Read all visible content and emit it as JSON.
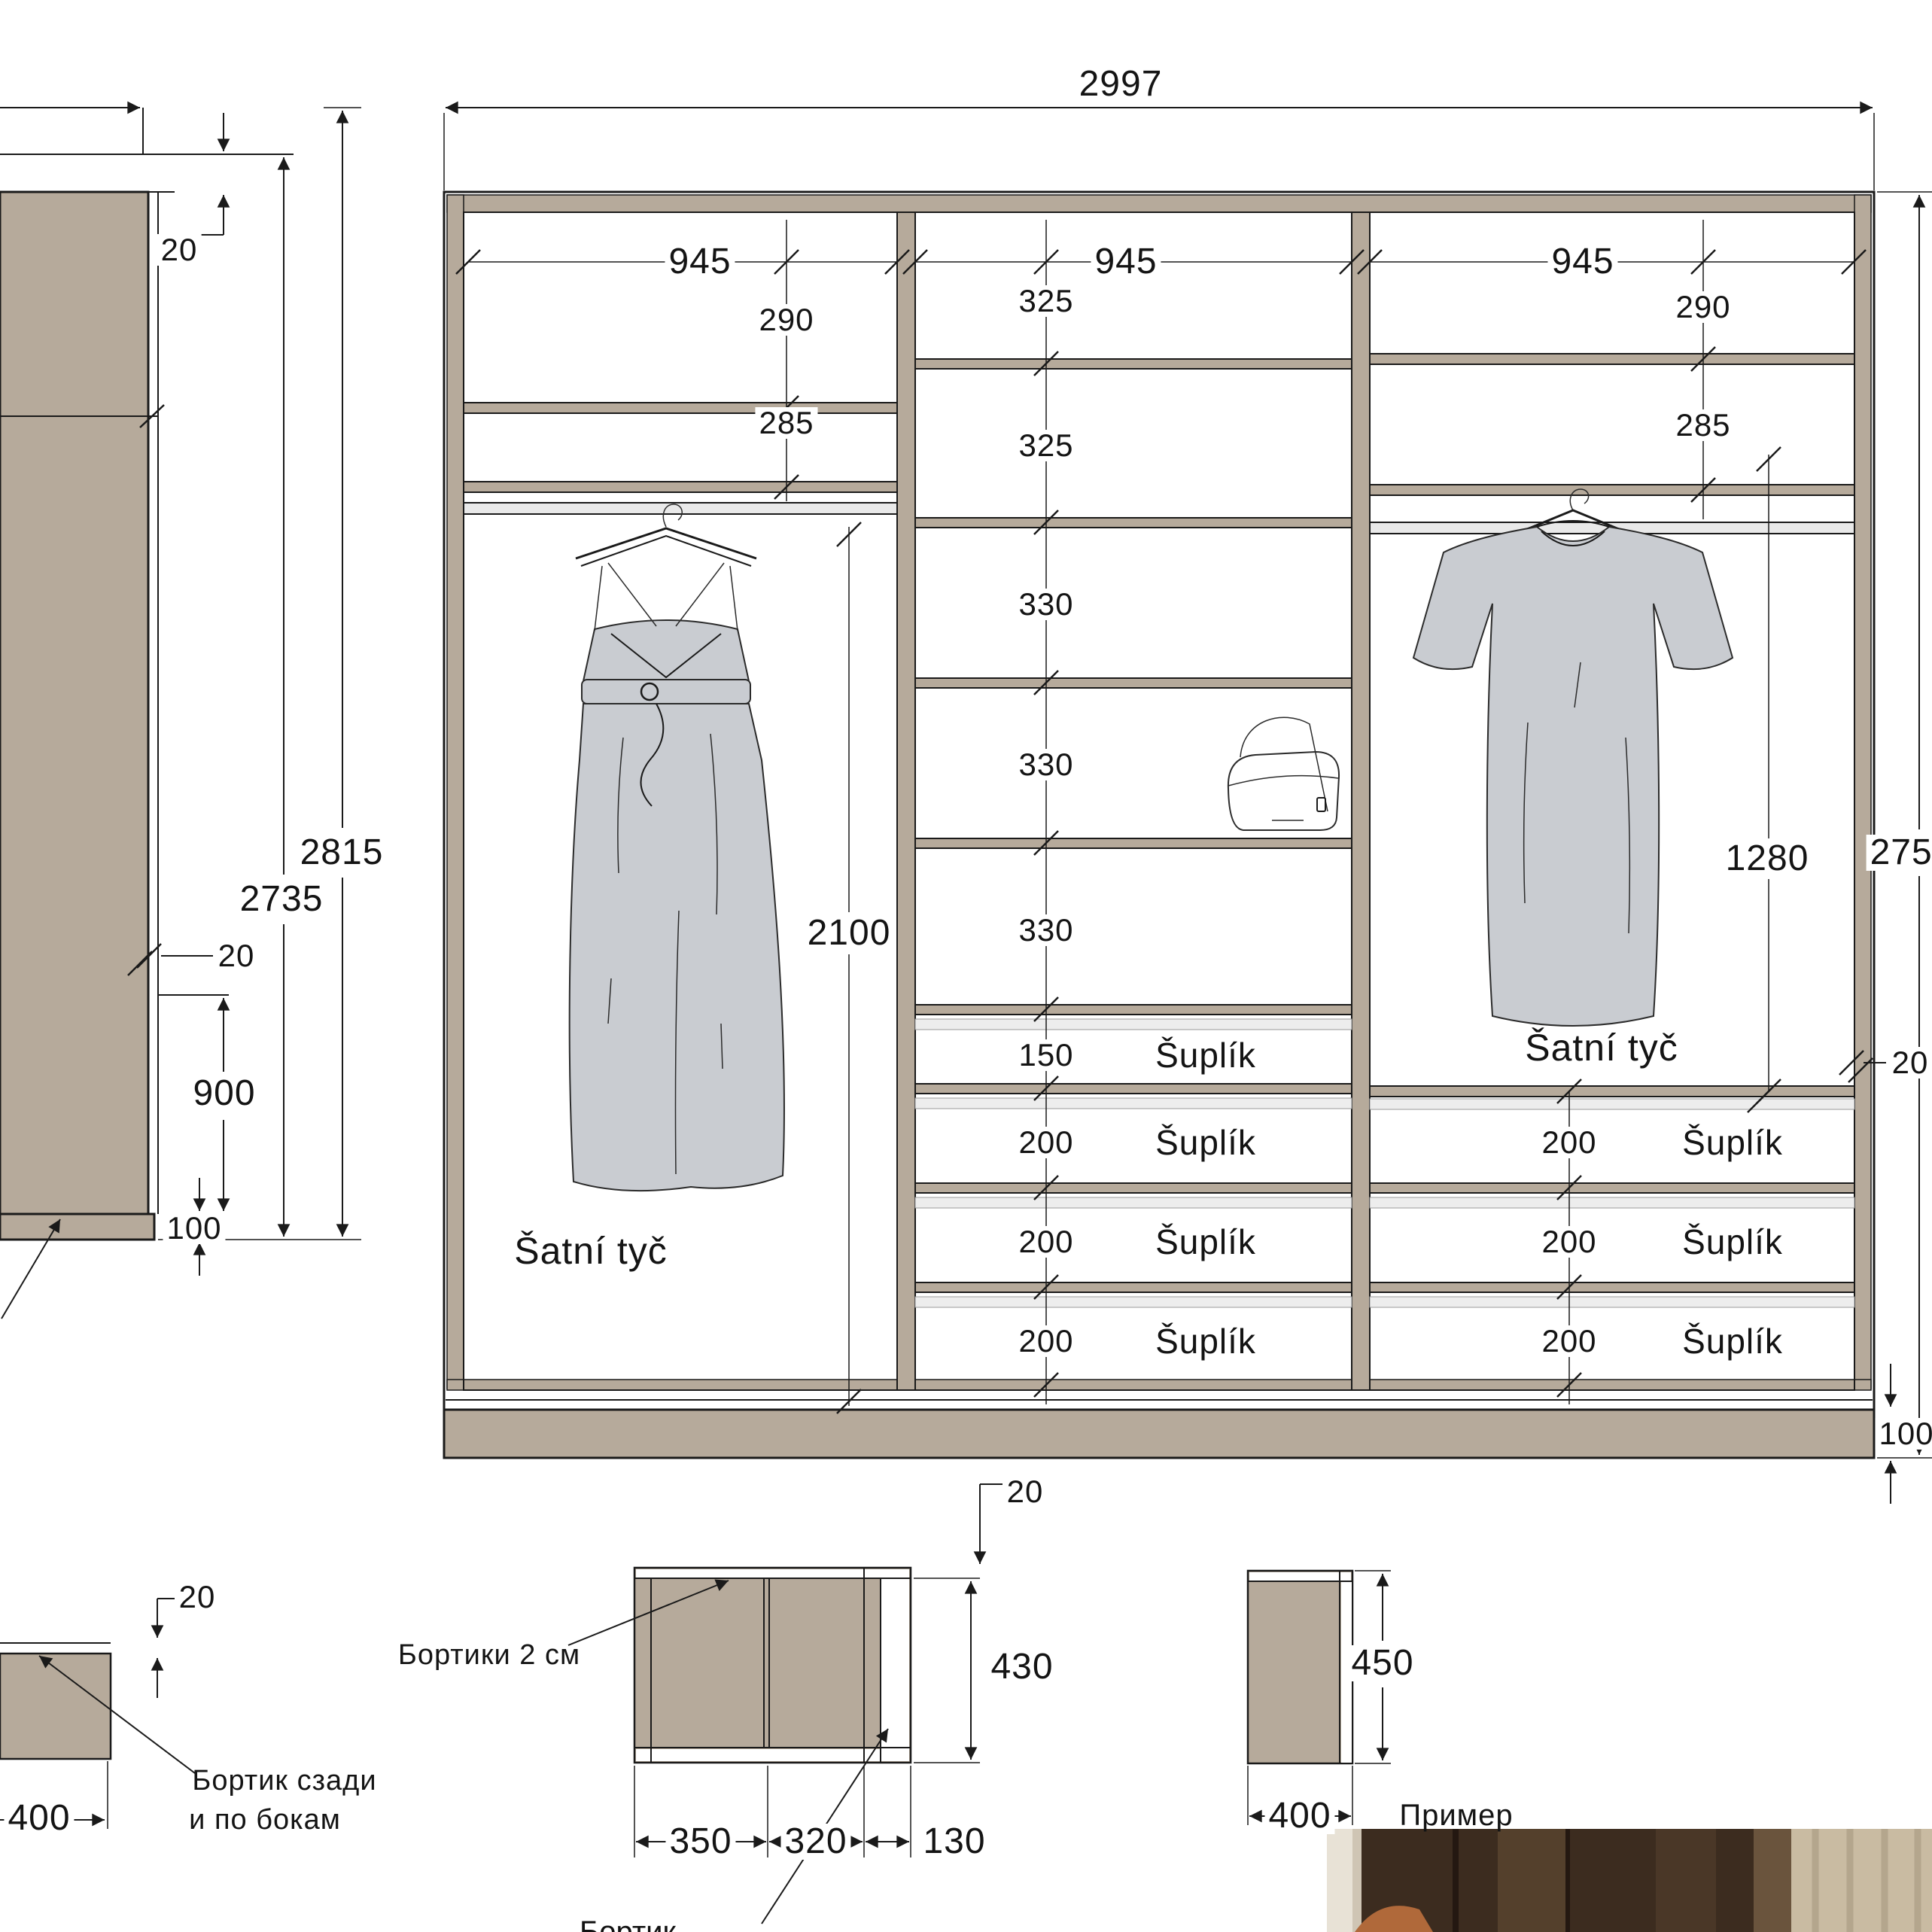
{
  "title": "Wardrobe build drawing",
  "colors": {
    "panel_tan": "#b6aa9b",
    "rod_gray": "#e9e9e9",
    "drawer_gap_gray": "#ededed",
    "garment_gray": "#c9ccd1",
    "line": "#1a1a1a",
    "photo_wood_dark": "#3c2c1f",
    "photo_curtain": "#c9bba2"
  },
  "main": {
    "total_width": "2997",
    "col1": {
      "width": "945",
      "r1": "290",
      "r2": "285",
      "rod_label": "Šatní tyč",
      "rod_h": "2100"
    },
    "col2": {
      "width": "945",
      "rows": [
        "325",
        "325",
        "330",
        "330",
        "330"
      ],
      "drawers": [
        {
          "h": "150",
          "t": "Šuplík"
        },
        {
          "h": "200",
          "t": "Šuplík"
        },
        {
          "h": "200",
          "t": "Šuplík"
        },
        {
          "h": "200",
          "t": "Šuplík"
        }
      ]
    },
    "col3": {
      "width": "945",
      "r1": "290",
      "r2": "285",
      "rod_label": "Šatní tyč",
      "rod_h": "1280",
      "drawers": [
        {
          "h": "200",
          "t": "Šuplík"
        },
        {
          "h": "200",
          "t": "Šuplík"
        },
        {
          "h": "200",
          "t": "Šuplík"
        }
      ]
    },
    "right": {
      "height": "2755",
      "thickness": "20",
      "plinth": "100"
    }
  },
  "side": {
    "h_total": "2815",
    "h_inner": "2735",
    "t_top": "20",
    "t_mid": "20",
    "rod_floor": "900",
    "plinth": "100"
  },
  "det_a": {
    "lip": "20",
    "depth": "400",
    "note1": "Бортик сзади",
    "note2": "и по бокам"
  },
  "det_b": {
    "note": "Бортики 2 см",
    "lip": "20",
    "height": "430",
    "w1": "350",
    "w2": "320",
    "w3": "130",
    "clipped": "Бортик"
  },
  "det_c": {
    "height": "450",
    "width": "400",
    "caption": "Пример"
  }
}
